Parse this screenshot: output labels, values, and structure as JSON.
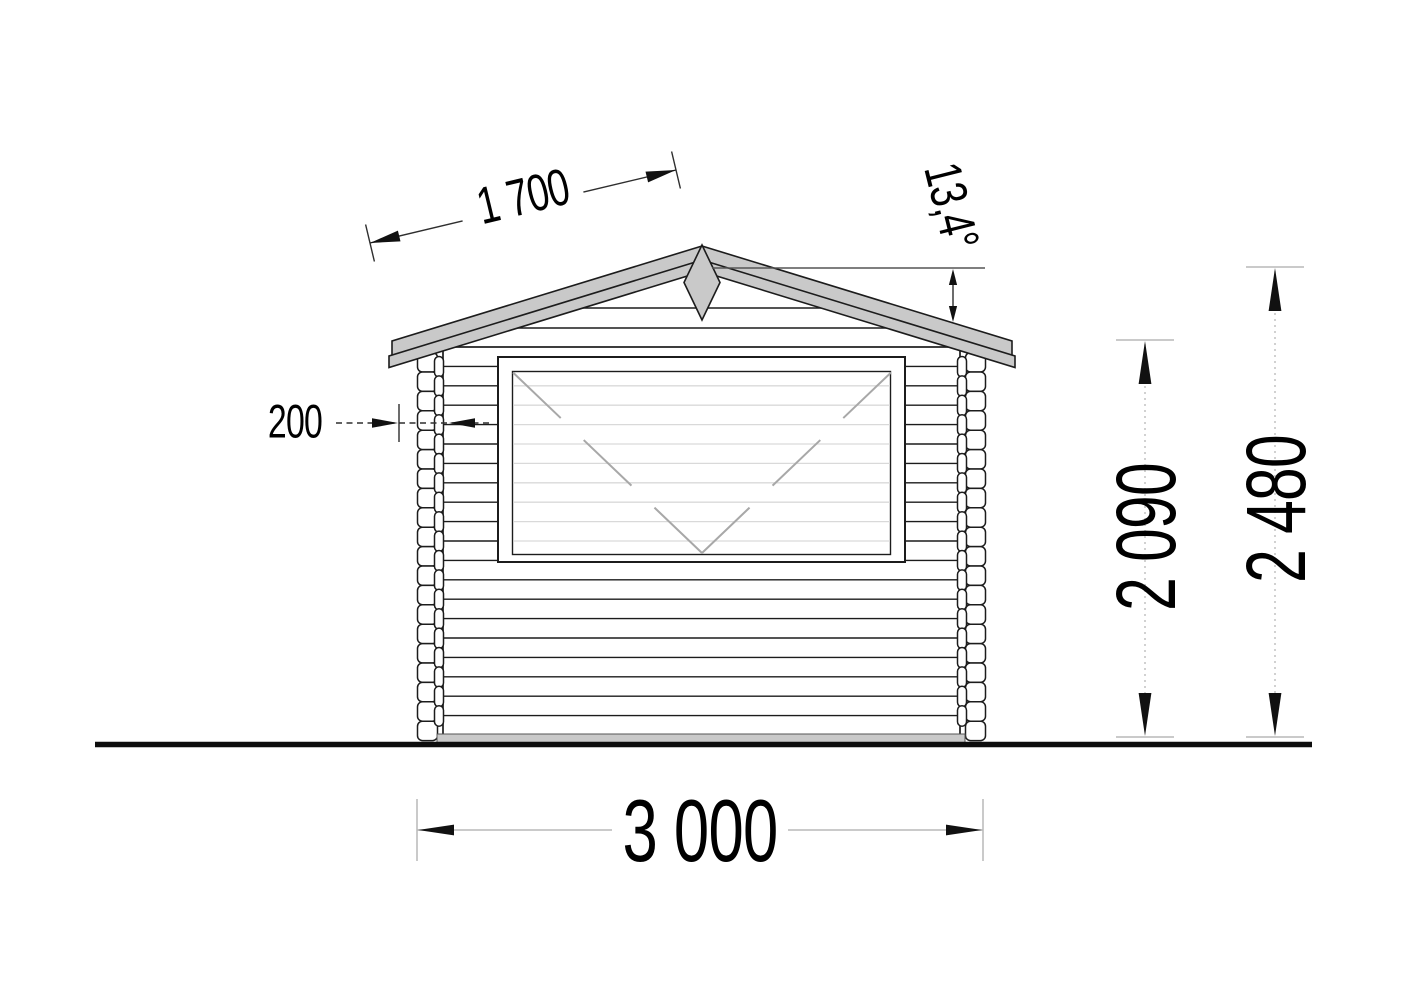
{
  "drawing": {
    "title": "Wooden cabin front elevation drawing",
    "labels": {
      "roof_slope_length": "1 700",
      "roof_angle": "13,4°",
      "wall_offset": "200",
      "overall_width": "3 000",
      "eave_height": "2 090",
      "ridge_height": "2 480"
    },
    "colors": {
      "line": "#1c1c1c",
      "roof_fill": "#c9c9c9",
      "base_fill": "#c9c9c9",
      "faint_line": "#d9d9d9",
      "glass_diagonal": "#a8a8a8",
      "dim_light": "#b8b8b8",
      "dim_dark": "#2e2e2e",
      "text": "#000000",
      "background": "#ffffff"
    }
  }
}
